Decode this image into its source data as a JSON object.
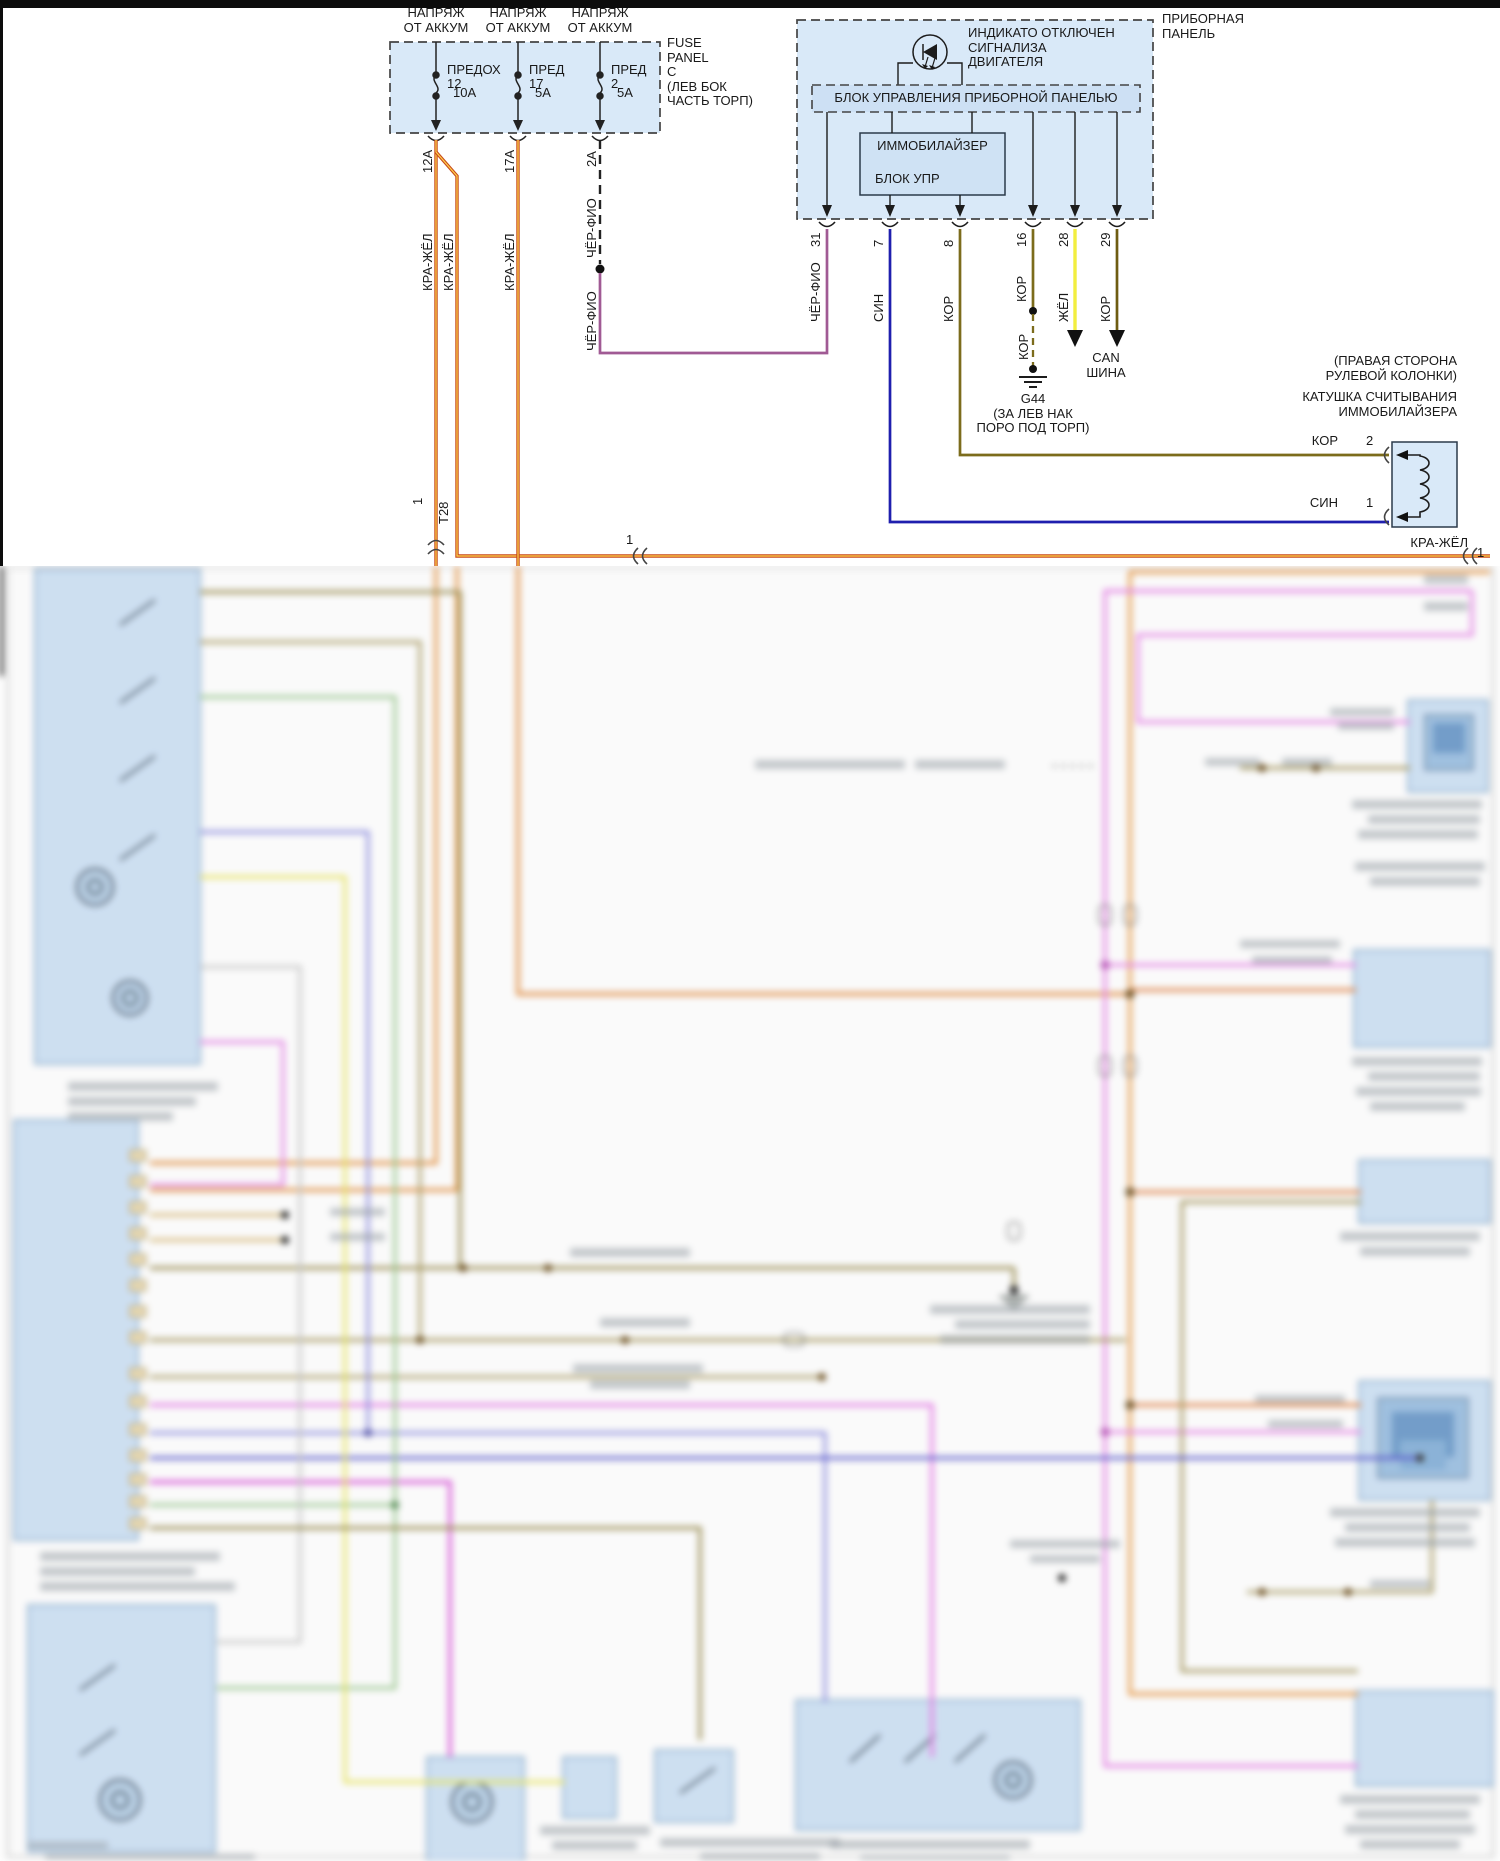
{
  "fuse_panel": {
    "feed_l1": "НАПРЯЖ",
    "feed_l2": "ОТ АККУМ",
    "fuses": [
      {
        "name": "ПРЕДОХ",
        "num": "12",
        "amp": "10А"
      },
      {
        "name": "ПРЕД",
        "num": "17",
        "amp": "5А"
      },
      {
        "name": "ПРЕД",
        "num": "2",
        "amp": "5А"
      }
    ],
    "caption": [
      "FUSE",
      "PANEL",
      "C",
      "(ЛЕВ БОК",
      "ЧАСТЬ ТОРП)"
    ]
  },
  "wires": {
    "w1_pin": "12А",
    "w1_color": "КРА-ЖЁЛ",
    "w1b_color": "КРА-ЖЁЛ",
    "w2_pin": "17А",
    "w2_color": "КРА-ЖЁЛ",
    "w3_pin": "2А",
    "w3_color": "ЧЁР-ФИО",
    "w3b_color": "ЧЁР-ФИО",
    "t28_pin": "1",
    "t28_name": "T28",
    "splice_pin": "1",
    "feed_color": "КРА-ЖЁЛ",
    "feed_pin": "1"
  },
  "panel": {
    "title": [
      "ПРИБОРНАЯ",
      "ПАНЕЛЬ"
    ],
    "indicator": [
      "ИНДИКАТО ОТКЛЮЧЕН",
      "СИГНАЛИЗА",
      "ДВИГАТЕЛЯ"
    ],
    "control": "БЛОК УПРАВЛЕНИЯ ПРИБОРНОЙ ПАНЕЛЬЮ",
    "immo": [
      "ИММОБИЛАЙЗЕР",
      "БЛОК УПР"
    ],
    "pins": [
      {
        "num": "31",
        "color": "ЧЁР-ФИО"
      },
      {
        "num": "7",
        "color": "СИН"
      },
      {
        "num": "8",
        "color": "КОР"
      },
      {
        "num": "16",
        "color": "КОР"
      },
      {
        "num": "28",
        "color": "ЖЁЛ"
      },
      {
        "num": "29",
        "color": "КОР"
      }
    ]
  },
  "ground": {
    "wire": "КОР",
    "id": "G44",
    "loc1": "(ЗА ЛЕВ НАК",
    "loc2": "ПОРО ПОД ТОРП)"
  },
  "can": [
    "CAN",
    "ШИНА"
  ],
  "coil": {
    "loc1": "(ПРАВАЯ СТОРОНА",
    "loc2": "РУЛЕВОЙ КОЛОНКИ)",
    "name1": "КАТУШКА СЧИТЫВАНИЯ",
    "name2": "ИММОБИЛАЙЗЕРА",
    "pin2_color": "КОР",
    "pin2": "2",
    "pin1_color": "СИН",
    "pin1": "1"
  },
  "colors": {
    "kra_zhel_outer": "#c8491a",
    "kra_zhel_core": "#ffd34d",
    "cher_fio": "#a05a94",
    "sin": "#1f1fae",
    "kor": "#7c6c1c",
    "kor_dark": "#6e5c12",
    "zhel": "#f2ee3f",
    "box_fill": "#d9e9f8"
  }
}
